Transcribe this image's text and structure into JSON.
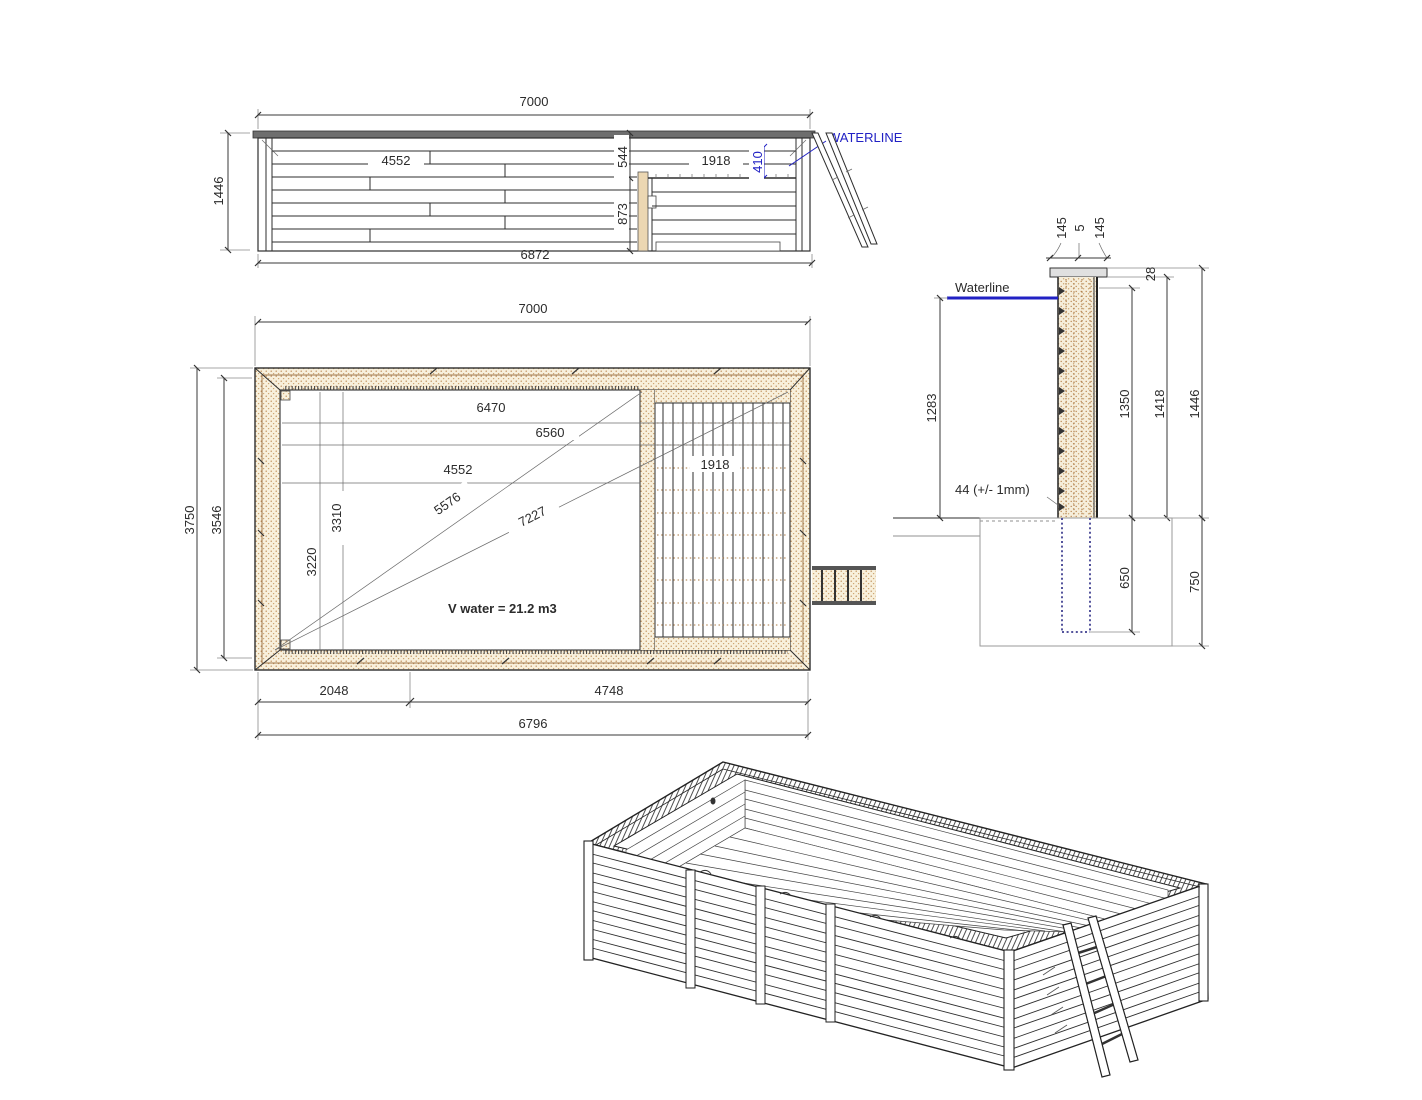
{
  "drawing": {
    "type": "wooden pool technical drawing",
    "colors": {
      "accent_blue": "#2121c4",
      "wood_tan": "#b9854e",
      "line": "#2e2e2e"
    }
  },
  "side_view": {
    "waterline": "WATERLINE",
    "dims": {
      "top": "7000",
      "left": "1446",
      "bottom": "6872",
      "inner": "4552",
      "bench_drop": "544",
      "bench_width": "1918",
      "water_depth": "410",
      "bench_height": "873"
    }
  },
  "plan_view": {
    "volume": "V water = 21.2 m3",
    "dims": {
      "top": "7000",
      "outer_height": "3750",
      "inner_height": "3546",
      "len1": "6470",
      "len2": "6560",
      "len3": "4552",
      "diag1": "5576",
      "diag2": "7227",
      "v1": "3310",
      "v2": "3220",
      "deck": "1918",
      "bottom_seg1": "2048",
      "bottom_seg2": "4748",
      "bottom_total": "6796"
    }
  },
  "section_view": {
    "waterline": "Waterline",
    "plank_note": "44 (+/- 1mm)",
    "dims": {
      "cap_left": "145",
      "cap_mid": "5",
      "cap_right": "145",
      "cap_height": "28",
      "depth_to_water": "1283",
      "wall_1350": "1350",
      "wall_1418": "1418",
      "wall_1446": "1446",
      "footing_650": "650",
      "footing_750": "750"
    }
  }
}
